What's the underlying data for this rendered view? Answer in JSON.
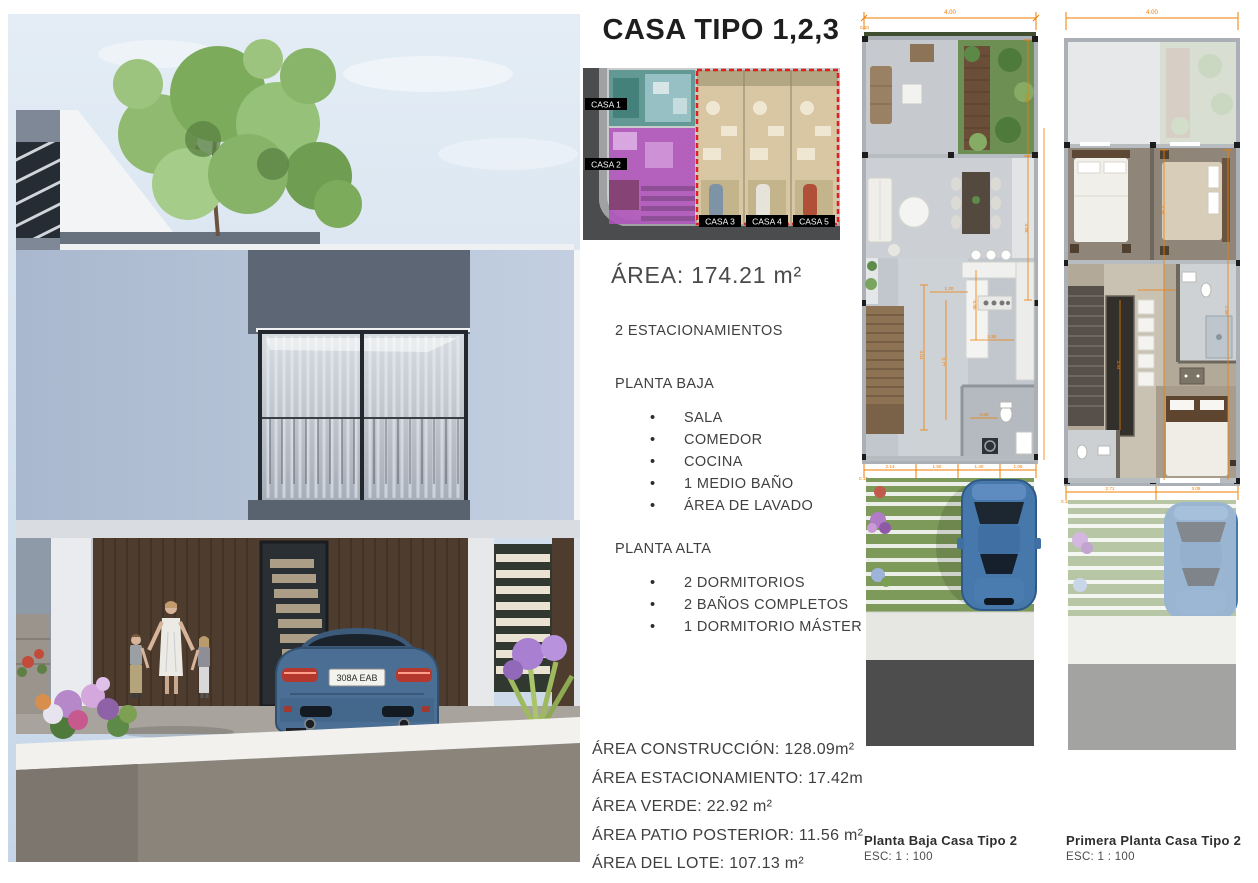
{
  "title": "CASA TIPO 1,2,3",
  "site_plan": {
    "unit_labels": [
      "CASA 1",
      "CASA 2",
      "CASA 3",
      "CASA 4",
      "CASA 5"
    ],
    "casa1_color": "#56948e",
    "casa2_color": "#b052bc",
    "casa345_color": "#d9c7a4",
    "highlight_border_color": "#e01f1f"
  },
  "summary": {
    "area": "ÁREA: 174.21 m²",
    "parking": "2 ESTACIONAMIENTOS"
  },
  "planta_baja": {
    "heading": "PLANTA BAJA",
    "items": [
      "SALA",
      "COMEDOR",
      "COCINA",
      "1 MEDIO BAÑO",
      "ÁREA DE LAVADO"
    ]
  },
  "planta_alta": {
    "heading": "PLANTA ALTA",
    "items": [
      "2 DORMITORIOS",
      "2 BAÑOS COMPLETOS",
      "1 DORMITORIO MÁSTER"
    ]
  },
  "area_details": [
    "ÁREA CONSTRUCCIÓN: 128.09m²",
    "ÁREA ESTACIONAMIENTO: 17.42m",
    "ÁREA VERDE: 22.92 m²",
    "ÁREA PATIO POSTERIOR: 11.56 m²",
    "ÁREA DEL LOTE: 107.13 m²"
  ],
  "plans": [
    {
      "caption": "Planta Baja Casa Tipo 2",
      "scale": "ESC: 1 : 100",
      "dims": {
        "width": "4.00",
        "offset": "0.10",
        "side_upper": "3.64",
        "side_lower": "3.88",
        "inner": [
          "4.01",
          "2.77",
          "1.20",
          "1.50",
          "0.90",
          "0.60"
        ],
        "bottom": [
          "2.14",
          "1.50",
          "1.40",
          "1.06"
        ],
        "bottom_left": "0.15"
      }
    },
    {
      "caption": "Primera Planta Casa Tipo 2",
      "scale": "ESC: 1 : 100",
      "dims": {
        "width": "4.00",
        "bedroom": "4.38",
        "stair": "3.94",
        "bath": "2.49",
        "bottom": [
          "2.71",
          "3.08"
        ],
        "bottom_left": "0.10"
      }
    }
  ],
  "render": {
    "car_plate": "308A EAB"
  },
  "dimension_color": "#f07d00"
}
